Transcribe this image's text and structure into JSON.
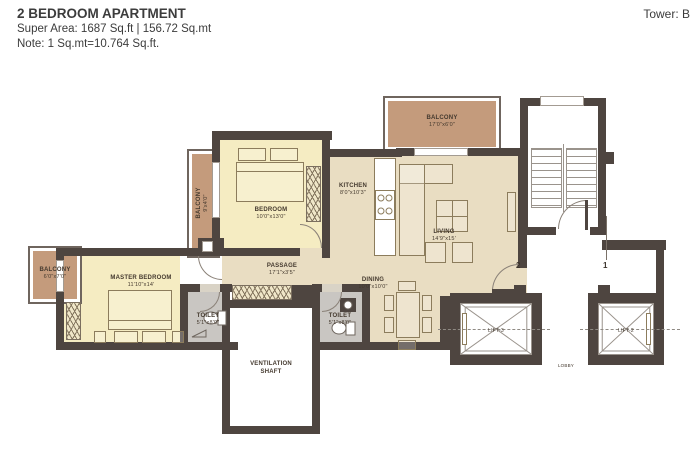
{
  "header": {
    "title": "2 BEDROOM APARTMENT",
    "super_area": "Super Area: 1687 Sq.ft | 156.72 Sq.mt",
    "note": "Note: 1 Sq.mt=10.764 Sq.ft.",
    "tower": "Tower: B"
  },
  "plan": {
    "balcony_top": {
      "label": "BALCONY",
      "dim": "17'0\"x6'0\""
    },
    "balcony_upper_left": {
      "label": "BALCONY",
      "dim": "9'x4'0\""
    },
    "balcony_lower_left": {
      "label": "BALCONY",
      "dim": "6'0\"x7'0\""
    },
    "bedroom": {
      "label": "BEDROOM",
      "dim": "10'0\"x13'0\""
    },
    "kitchen": {
      "label": "KITCHEN",
      "dim": "8'0\"x10'3\""
    },
    "living": {
      "label": "LIVING",
      "dim": "14'9\"x15'"
    },
    "master_bedroom": {
      "label": "MASTER BEDROOM",
      "dim": "11'10\"x14'"
    },
    "passage": {
      "label": "PASSAGE",
      "dim": "17'1\"x3'5\""
    },
    "dining": {
      "label": "DINING",
      "dim": "10'0\"x10'0\""
    },
    "toilet_master": {
      "label": "TOILET",
      "dim": "5'1\"x8'0\""
    },
    "toilet_common": {
      "label": "TOILET",
      "dim": "5'1\"x8'0\""
    },
    "ventilation_shaft": {
      "label": "VENTILATION SHAFT"
    },
    "lift_3": {
      "label": "LIFT-3"
    },
    "lift_2": {
      "label": "LIFT-2"
    },
    "lobby": {
      "label": "LOBBY"
    },
    "grid_marker_2": "2",
    "grid_marker_1": "1"
  },
  "colors": {
    "wall": "#4e4540",
    "bedroom_fill": "#f5ecc2",
    "open_area_fill": "#e9ddc2",
    "balcony_fill": "#c49b7c",
    "toilet_fill": "#c9c6c2"
  }
}
